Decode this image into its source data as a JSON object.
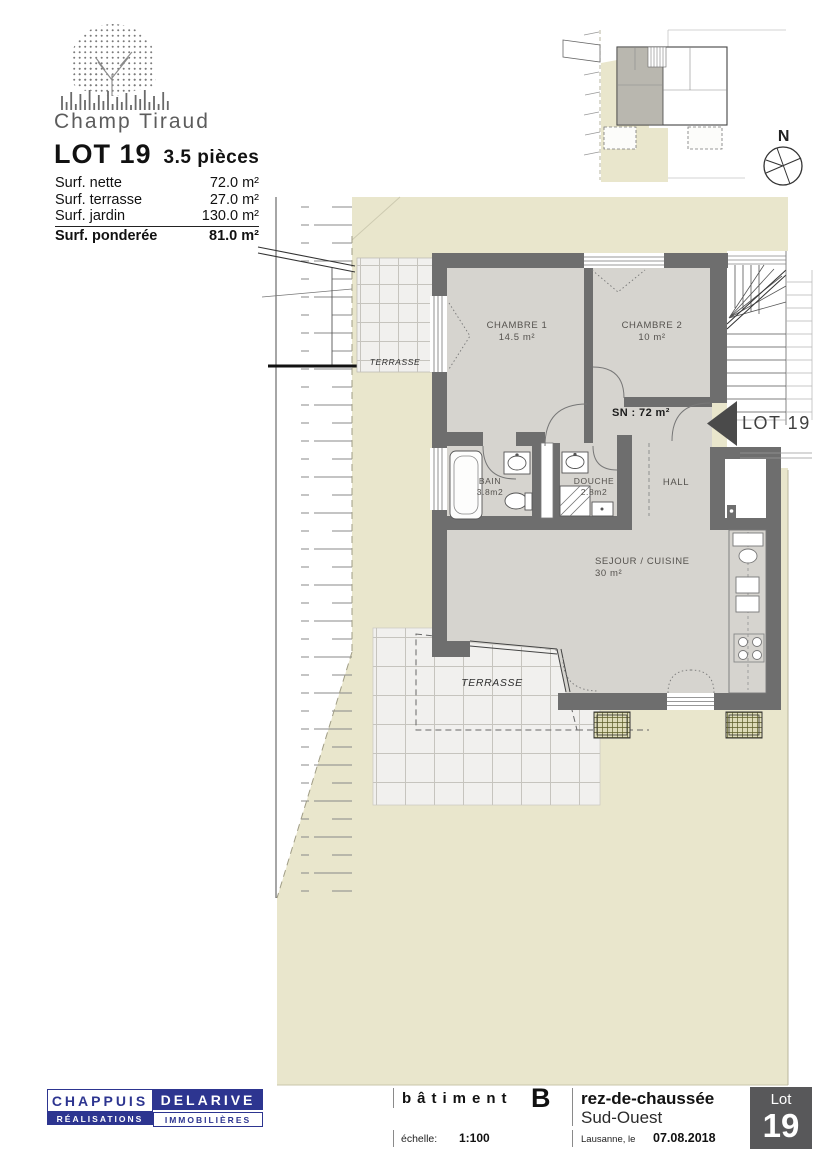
{
  "header": {
    "project_name": "Champ Tiraud",
    "lot_title": "LOT 19",
    "lot_pieces": "3.5 pièces",
    "surface_rows": [
      {
        "label": "Surf. nette",
        "value": "72.0 m²"
      },
      {
        "label": "Surf. terrasse",
        "value": "27.0 m²"
      },
      {
        "label": "Surf. jardin",
        "value": "130.0 m²"
      },
      {
        "label": "Surf. ponderée",
        "value": "81.0 m²"
      }
    ]
  },
  "key_plan": {
    "north_label": "N"
  },
  "plan": {
    "rooms": {
      "chambre1": {
        "name": "CHAMBRE 1",
        "area": "14.5 m²"
      },
      "chambre2": {
        "name": "CHAMBRE 2",
        "area": "10 m²"
      },
      "bain": {
        "name": "BAIN",
        "area": "3.8m2"
      },
      "douche": {
        "name": "DOUCHE",
        "area": "2.8m2"
      },
      "hall": {
        "name": "HALL"
      },
      "sejour": {
        "name": "SEJOUR / CUISINE",
        "area": "30 m²"
      }
    },
    "net_surface_label": "SN : 72 m²",
    "entrance_label": "LOT 19",
    "terrace_upper_label": "TERRASSE",
    "terrace_lower_label": "TERRASSE"
  },
  "footer": {
    "brand": {
      "top_left": "CHAPPUIS",
      "top_right": "DELARIVE",
      "bottom_left": "RÉALISATIONS",
      "bottom_right": "IMMOBILIÈRES"
    },
    "building_label": "bâtiment",
    "building_value": "B",
    "floor_label": "rez-de-chaussée",
    "orientation": "Sud-Ouest",
    "scale_label": "échelle:",
    "scale_value": "1:100",
    "city_label": "Lausanne, le",
    "date": "07.08.2018",
    "lot_box": {
      "label": "Lot",
      "number": "19"
    }
  },
  "colors": {
    "brand_navy": "#2d3590",
    "wall_gray": "#6e6e6e",
    "garden_beige": "#e9e6cc",
    "room_floor": "#d6d4cf",
    "lot_box_gray": "#58585a"
  }
}
